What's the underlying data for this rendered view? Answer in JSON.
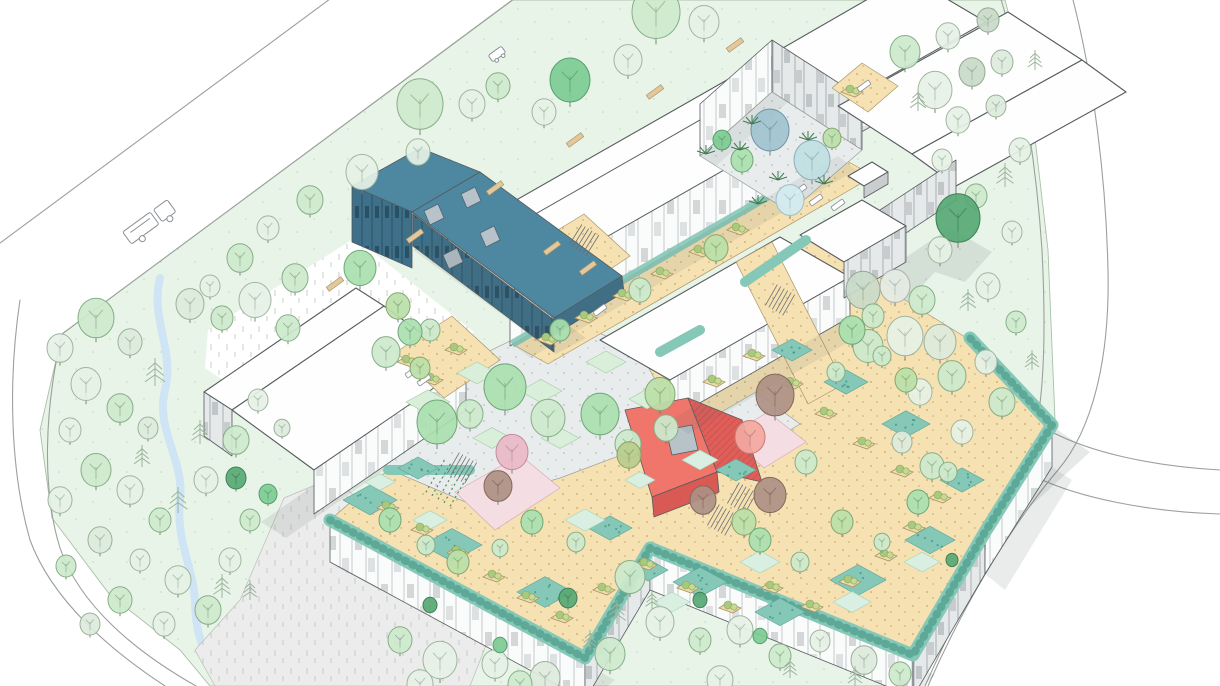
{
  "meta": {
    "title": "Hand-drawn style architectural aerial axonometric illustration",
    "description": "Masterplan bird's-eye sketch of a healthcare / campus building complex with white roofs, grey striped facades, a teal gabled hall with four skylights, a coral gabled house, inner courtyards with trees, tan roof terraces with teal green-roof walkways and planters, set in a light green meadow with scattered sketch trees, perimeter roads, a stream and a bus on the north-west road."
  },
  "palette": {
    "bg": "#ffffff",
    "meadow": "#e9f4e9",
    "meadow_edge": "#a9bfa9",
    "roof": "#fefefe",
    "teal_roof": "#4e87a0",
    "teal_wall": "#3e7089",
    "red_roof": "#f0756b",
    "red_roof_shade": "#e05e59",
    "red_wall": "#d95954",
    "skylight": "#b7c2c9",
    "tan": "#f6e1b2",
    "teal_band": "#85c8b8",
    "teal_band_dot": "#3e8e7e",
    "pink_path": "#f5dee3",
    "paving": "#e9ecec",
    "lawn": "#d9efda",
    "mint": "#d8efe2",
    "stream": "#cfe4f4",
    "bench": "#e2c89a",
    "shadow": "#52605f",
    "trunk": "#6b7b6b",
    "pine": "#9cb49c",
    "fern": "#3f7a4f"
  },
  "trees": {
    "colors": {
      "pale": [
        "#e6f1e6",
        "#9fb59f"
      ],
      "pale2": [
        "#dceadc",
        "#9ab09a"
      ],
      "lt": [
        "#cde9cd",
        "#86ae86"
      ],
      "med": [
        "#a9dfaf",
        "#6fa576"
      ],
      "med2": [
        "#bbdfa9",
        "#84a56e"
      ],
      "deep": [
        "#7ccb92",
        "#579d6c"
      ],
      "dark": [
        "#57a874",
        "#3f7f57"
      ],
      "sage": [
        "#c9dac9",
        "#93a893"
      ],
      "gray": [
        "#e4eae4",
        "#a8b2a8"
      ],
      "blue1": [
        "#9fc2ce",
        "#6f93a1"
      ],
      "blue2": [
        "#bfdee2",
        "#8bafb5"
      ],
      "blue3": [
        "#d2ebf0",
        "#9fbfc6"
      ],
      "pink": [
        "#e9b9c8",
        "#bf8a9d"
      ],
      "brown": [
        "#ad9084",
        "#82685c"
      ],
      "salmon": [
        "#f2a8a0",
        "#c47b74"
      ],
      "olive": [
        "#b8cc8d",
        "#8c9f60"
      ]
    },
    "items": [
      [
        656,
        12,
        24,
        "lt"
      ],
      [
        704,
        22,
        15,
        "pale"
      ],
      [
        628,
        60,
        14,
        "pale"
      ],
      [
        570,
        80,
        20,
        "deep"
      ],
      [
        544,
        112,
        12,
        "pale"
      ],
      [
        498,
        86,
        12,
        "lt"
      ],
      [
        472,
        104,
        13,
        "pale"
      ],
      [
        420,
        104,
        23,
        "lt"
      ],
      [
        418,
        152,
        12,
        "pale"
      ],
      [
        362,
        172,
        16,
        "pale"
      ],
      [
        310,
        200,
        13,
        "lt"
      ],
      [
        268,
        228,
        11,
        "pale"
      ],
      [
        240,
        258,
        13,
        "lt"
      ],
      [
        210,
        286,
        10,
        "pale"
      ],
      [
        190,
        304,
        14,
        "pale2"
      ],
      [
        222,
        318,
        11,
        "lt"
      ],
      [
        96,
        318,
        18,
        "lt"
      ],
      [
        60,
        348,
        13,
        "pale"
      ],
      [
        130,
        342,
        12,
        "pale2"
      ],
      [
        86,
        384,
        15,
        "pale"
      ],
      [
        120,
        408,
        13,
        "lt"
      ],
      [
        70,
        430,
        11,
        "pale"
      ],
      [
        148,
        428,
        10,
        "pale2"
      ],
      [
        96,
        470,
        15,
        "lt"
      ],
      [
        60,
        500,
        12,
        "pale"
      ],
      [
        130,
        490,
        13,
        "pale"
      ],
      [
        160,
        520,
        11,
        "lt"
      ],
      [
        100,
        540,
        12,
        "pale2"
      ],
      [
        66,
        566,
        10,
        "lt"
      ],
      [
        140,
        560,
        10,
        "pale"
      ],
      [
        178,
        580,
        13,
        "pale"
      ],
      [
        120,
        600,
        12,
        "lt"
      ],
      [
        90,
        624,
        10,
        "pale2"
      ],
      [
        164,
        624,
        11,
        "pale"
      ],
      [
        208,
        610,
        13,
        "lt"
      ],
      [
        230,
        560,
        11,
        "pale"
      ],
      [
        250,
        520,
        10,
        "lt"
      ],
      [
        206,
        480,
        12,
        "pale"
      ],
      [
        236,
        440,
        13,
        "lt"
      ],
      [
        258,
        400,
        10,
        "pale"
      ],
      [
        282,
        428,
        8,
        "pale2"
      ],
      [
        255,
        300,
        16,
        "pale"
      ],
      [
        288,
        328,
        12,
        "lt"
      ],
      [
        155,
        372,
        14,
        "pine",
        "p"
      ],
      [
        200,
        432,
        12,
        "pine",
        "p"
      ],
      [
        178,
        500,
        13,
        "pine",
        "p"
      ],
      [
        222,
        586,
        12,
        "pine",
        "p"
      ],
      [
        142,
        456,
        11,
        "pine",
        "p"
      ],
      [
        250,
        590,
        10,
        "pine",
        "p"
      ],
      [
        360,
        268,
        16,
        "med"
      ],
      [
        295,
        278,
        13,
        "lt"
      ],
      [
        398,
        306,
        12,
        "med2"
      ],
      [
        430,
        330,
        10,
        "lt"
      ],
      [
        236,
        478,
        10,
        "dark"
      ],
      [
        268,
        494,
        9,
        "deep"
      ],
      [
        440,
        660,
        17,
        "pale"
      ],
      [
        400,
        640,
        12,
        "lt"
      ],
      [
        495,
        664,
        13,
        "pale"
      ],
      [
        545,
        678,
        15,
        "pale2"
      ],
      [
        610,
        654,
        15,
        "lt"
      ],
      [
        568,
        598,
        9,
        "dark"
      ],
      [
        630,
        577,
        15,
        "lt"
      ],
      [
        660,
        622,
        14,
        "pale"
      ],
      [
        700,
        640,
        11,
        "lt"
      ],
      [
        740,
        630,
        13,
        "pale"
      ],
      [
        780,
        656,
        11,
        "lt"
      ],
      [
        820,
        641,
        10,
        "pale"
      ],
      [
        864,
        660,
        13,
        "pale2"
      ],
      [
        900,
        674,
        11,
        "lt"
      ],
      [
        420,
        684,
        13,
        "pale"
      ],
      [
        520,
        684,
        12,
        "lt"
      ],
      [
        720,
        680,
        13,
        "pale"
      ],
      [
        617,
        612,
        12,
        "pine",
        "p"
      ],
      [
        590,
        640,
        10,
        "pine",
        "p"
      ],
      [
        652,
        600,
        9,
        "pine",
        "p"
      ],
      [
        790,
        668,
        10,
        "pine",
        "p"
      ],
      [
        855,
        676,
        10,
        "pine",
        "p"
      ],
      [
        905,
        52,
        15,
        "lt"
      ],
      [
        948,
        36,
        12,
        "pale"
      ],
      [
        988,
        20,
        11,
        "sage"
      ],
      [
        935,
        90,
        17,
        "pale"
      ],
      [
        972,
        72,
        13,
        "sage"
      ],
      [
        1002,
        62,
        11,
        "pale2"
      ],
      [
        958,
        120,
        12,
        "pale"
      ],
      [
        996,
        106,
        10,
        "pale2"
      ],
      [
        942,
        160,
        10,
        "pale"
      ],
      [
        1020,
        150,
        11,
        "pale"
      ],
      [
        976,
        196,
        11,
        "lt"
      ],
      [
        1012,
        232,
        10,
        "pale"
      ],
      [
        958,
        218,
        22,
        "dark"
      ],
      [
        863,
        290,
        17,
        "sage"
      ],
      [
        895,
        286,
        15,
        "gray"
      ],
      [
        922,
        300,
        13,
        "lt"
      ],
      [
        940,
        250,
        12,
        "pale"
      ],
      [
        873,
        316,
        11,
        "lt"
      ],
      [
        905,
        336,
        18,
        "pale"
      ],
      [
        868,
        346,
        15,
        "lt"
      ],
      [
        940,
        342,
        16,
        "pale2"
      ],
      [
        952,
        376,
        14,
        "lt"
      ],
      [
        920,
        392,
        12,
        "pale"
      ],
      [
        988,
        286,
        12,
        "pale"
      ],
      [
        1016,
        322,
        10,
        "lt"
      ],
      [
        986,
        362,
        11,
        "pale"
      ],
      [
        1002,
        402,
        13,
        "lt"
      ],
      [
        962,
        432,
        11,
        "pale"
      ],
      [
        932,
        466,
        12,
        "lt"
      ],
      [
        902,
        442,
        10,
        "pale2"
      ],
      [
        1005,
        175,
        12,
        "pine",
        "p"
      ],
      [
        968,
        300,
        11,
        "pine",
        "p"
      ],
      [
        1032,
        360,
        10,
        "pine",
        "p"
      ],
      [
        918,
        100,
        11,
        "pine",
        "p"
      ],
      [
        1035,
        60,
        10,
        "pine",
        "p"
      ],
      [
        437,
        422,
        20,
        "med"
      ],
      [
        505,
        387,
        21,
        "med"
      ],
      [
        470,
        414,
        13,
        "lt"
      ],
      [
        548,
        418,
        17,
        "lt"
      ],
      [
        600,
        414,
        19,
        "med"
      ],
      [
        628,
        444,
        13,
        "lt"
      ],
      [
        660,
        394,
        15,
        "med2"
      ],
      [
        666,
        428,
        12,
        "lt"
      ],
      [
        512,
        452,
        16,
        "pink"
      ],
      [
        498,
        486,
        14,
        "brown"
      ],
      [
        629,
        455,
        12,
        "olive"
      ],
      [
        770,
        130,
        19,
        "blue1"
      ],
      [
        812,
        160,
        18,
        "blue2"
      ],
      [
        790,
        200,
        14,
        "blue3"
      ],
      [
        742,
        160,
        11,
        "med"
      ],
      [
        832,
        138,
        9,
        "med2"
      ],
      [
        722,
        140,
        9,
        "deep"
      ],
      [
        740,
        150,
        0,
        "fern",
        "f"
      ],
      [
        778,
        180,
        0,
        "fern",
        "f"
      ],
      [
        808,
        140,
        0,
        "fern",
        "f"
      ],
      [
        758,
        204,
        0,
        "fern",
        "f"
      ],
      [
        824,
        184,
        0,
        "fern",
        "f"
      ],
      [
        706,
        154,
        0,
        "fern",
        "f"
      ],
      [
        752,
        124,
        0,
        "fern",
        "f"
      ],
      [
        775,
        395,
        19,
        "brown"
      ],
      [
        750,
        437,
        15,
        "salmon"
      ],
      [
        770,
        495,
        16,
        "brown"
      ],
      [
        806,
        462,
        11,
        "lt"
      ],
      [
        744,
        522,
        12,
        "med2"
      ],
      [
        703,
        500,
        13,
        "brown"
      ],
      [
        390,
        520,
        11,
        "med"
      ],
      [
        426,
        545,
        9,
        "lt"
      ],
      [
        458,
        562,
        11,
        "med2"
      ],
      [
        500,
        548,
        8,
        "lt"
      ],
      [
        532,
        522,
        11,
        "med"
      ],
      [
        576,
        542,
        9,
        "lt"
      ],
      [
        760,
        540,
        11,
        "med"
      ],
      [
        800,
        562,
        9,
        "lt"
      ],
      [
        842,
        522,
        11,
        "med2"
      ],
      [
        882,
        542,
        8,
        "lt"
      ],
      [
        918,
        502,
        11,
        "med"
      ],
      [
        948,
        472,
        9,
        "lt"
      ],
      [
        852,
        330,
        13,
        "med"
      ],
      [
        882,
        356,
        9,
        "lt"
      ],
      [
        906,
        380,
        11,
        "med2"
      ],
      [
        836,
        372,
        9,
        "lt"
      ],
      [
        560,
        330,
        10,
        "med"
      ],
      [
        640,
        290,
        11,
        "lt"
      ],
      [
        716,
        248,
        12,
        "med2"
      ],
      [
        410,
        332,
        12,
        "med"
      ],
      [
        386,
        352,
        14,
        "lt"
      ],
      [
        420,
        368,
        10,
        "med2"
      ],
      [
        430,
        605,
        7,
        "dark"
      ],
      [
        500,
        645,
        7,
        "deep"
      ],
      [
        700,
        600,
        7,
        "dark"
      ],
      [
        760,
        636,
        7,
        "deep"
      ],
      [
        952,
        560,
        6,
        "dark"
      ]
    ]
  },
  "lawns": [
    [
      428,
      402,
      44,
      "lawn"
    ],
    [
      477,
      373,
      40,
      "lawn"
    ],
    [
      541,
      391,
      42,
      "lawn"
    ],
    [
      606,
      362,
      40,
      "lawn"
    ],
    [
      647,
      399,
      36,
      "lawn"
    ],
    [
      492,
      438,
      38,
      "lawn"
    ],
    [
      560,
      438,
      38,
      "lawn"
    ],
    [
      370,
      500,
      54,
      "teal"
    ],
    [
      452,
      545,
      60,
      "teal"
    ],
    [
      545,
      592,
      56,
      "teal"
    ],
    [
      648,
      570,
      40,
      "teal"
    ],
    [
      700,
      582,
      54,
      "teal"
    ],
    [
      780,
      612,
      50,
      "teal"
    ],
    [
      858,
      580,
      56,
      "teal"
    ],
    [
      930,
      540,
      50,
      "teal"
    ],
    [
      962,
      480,
      44,
      "teal"
    ],
    [
      906,
      424,
      48,
      "teal"
    ],
    [
      846,
      382,
      44,
      "teal"
    ],
    [
      792,
      350,
      40,
      "teal"
    ],
    [
      418,
      468,
      40,
      "teal"
    ],
    [
      610,
      528,
      44,
      "teal"
    ],
    [
      736,
      470,
      40,
      "teal"
    ],
    [
      585,
      520,
      40,
      "mint"
    ],
    [
      672,
      602,
      36,
      "mint"
    ],
    [
      760,
      562,
      40,
      "mint"
    ],
    [
      852,
      602,
      38,
      "mint"
    ],
    [
      922,
      562,
      36,
      "mint"
    ],
    [
      430,
      520,
      34,
      "mint"
    ],
    [
      380,
      482,
      30,
      "mint"
    ],
    [
      700,
      460,
      36,
      "mint"
    ],
    [
      640,
      480,
      30,
      "mint"
    ]
  ],
  "planters": [
    [
      388,
      508
    ],
    [
      422,
      530
    ],
    [
      458,
      553
    ],
    [
      494,
      577
    ],
    [
      528,
      598
    ],
    [
      562,
      618
    ],
    [
      604,
      590
    ],
    [
      646,
      565
    ],
    [
      688,
      588
    ],
    [
      730,
      608
    ],
    [
      772,
      588
    ],
    [
      812,
      607
    ],
    [
      850,
      582
    ],
    [
      886,
      556
    ],
    [
      914,
      528
    ],
    [
      940,
      498
    ],
    [
      902,
      472
    ],
    [
      864,
      444
    ],
    [
      826,
      414
    ],
    [
      792,
      384
    ],
    [
      754,
      356
    ],
    [
      714,
      382
    ],
    [
      548,
      340
    ],
    [
      586,
      318
    ],
    [
      624,
      296
    ],
    [
      662,
      274
    ],
    [
      700,
      252
    ],
    [
      738,
      230
    ],
    [
      408,
      362
    ],
    [
      432,
      380
    ],
    [
      456,
      350
    ],
    [
      852,
      92
    ]
  ],
  "benches": [
    [
      735,
      45,
      -36
    ],
    [
      655,
      92,
      -36
    ],
    [
      575,
      140,
      -36
    ],
    [
      495,
      188,
      -36
    ],
    [
      415,
      236,
      -36
    ],
    [
      335,
      284,
      -36
    ],
    [
      552,
      248,
      -36
    ],
    [
      588,
      268,
      -36
    ]
  ],
  "loungers": [
    [
      800,
      190
    ],
    [
      816,
      200
    ],
    [
      838,
      205
    ],
    [
      412,
      372
    ],
    [
      424,
      380
    ],
    [
      864,
      86
    ],
    [
      600,
      310
    ]
  ],
  "stairs": [
    [
      462,
      468,
      30
    ],
    [
      742,
      498,
      30
    ],
    [
      780,
      300,
      30
    ],
    [
      584,
      240,
      32
    ],
    [
      722,
      520,
      30
    ]
  ]
}
